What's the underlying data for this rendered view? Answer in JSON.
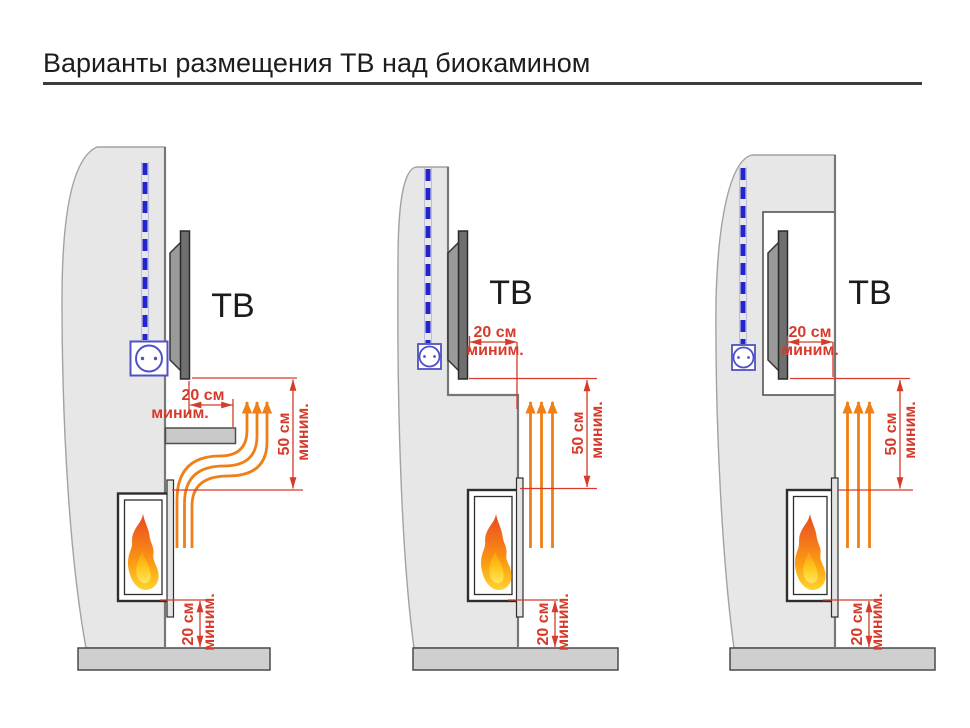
{
  "header": {
    "title": "Варианты размещения ТВ над биокамином"
  },
  "colors": {
    "dimension_red": "#d63a2a",
    "airflow_orange": "#ef7f17",
    "cable_blue": "#2424cc",
    "outlet_blue": "#5151c6",
    "wall_gray": "#e7e7e7",
    "floor_gray": "#cfcfcf",
    "tv_gray": "#6f6f6f",
    "flame_red": "#e84a1f",
    "flame_orange": "#fb9d12",
    "flame_yellow": "#ffd42e"
  },
  "diagrams": [
    {
      "id": "variant-mantel-shelf",
      "tv_label": "ТВ",
      "dims": {
        "top": {
          "value": "20 см",
          "qualifier": "миним."
        },
        "right": {
          "value": "50 см",
          "qualifier": "миним."
        },
        "bottom": {
          "value": "20 см",
          "qualifier": "миним."
        }
      }
    },
    {
      "id": "variant-recessed-tv",
      "tv_label": "ТВ",
      "dims": {
        "top": {
          "value": "20 см",
          "qualifier": "миним."
        },
        "right": {
          "value": "50 см",
          "qualifier": "миним."
        },
        "bottom": {
          "value": "20 см",
          "qualifier": "миним."
        }
      }
    },
    {
      "id": "variant-tv-niche",
      "tv_label": "ТВ",
      "dims": {
        "top": {
          "value": "20 см",
          "qualifier": "миним."
        },
        "right": {
          "value": "50 см",
          "qualifier": "миним."
        },
        "bottom": {
          "value": "20 см",
          "qualifier": "миним."
        }
      }
    }
  ]
}
